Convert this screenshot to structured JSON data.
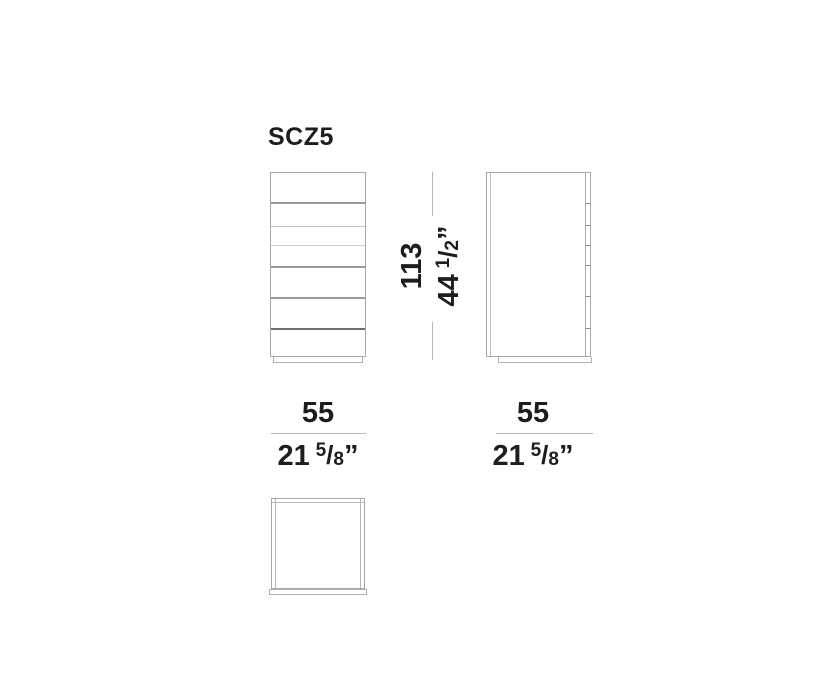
{
  "title": "SCZ5",
  "dimensions": {
    "height": {
      "cm": "113",
      "inch_whole": "44",
      "frac_num": "1",
      "frac_slash": "/",
      "frac_den": "2",
      "unit": "”"
    },
    "width": {
      "cm": "55",
      "inch_whole": "21",
      "frac_num": "5",
      "frac_slash": "/",
      "frac_den": "8",
      "unit": "”"
    },
    "depth": {
      "cm": "55",
      "inch_whole": "21",
      "frac_num": "5",
      "frac_slash": "/",
      "frac_den": "8",
      "unit": "”"
    }
  },
  "views": {
    "front": "front-view",
    "side": "side-view",
    "top": "top-view"
  },
  "colors": {
    "text": "#1d1d1b",
    "outline": "#a7a7a7",
    "dimension_line": "#b5b5b5",
    "background": "#ffffff"
  }
}
